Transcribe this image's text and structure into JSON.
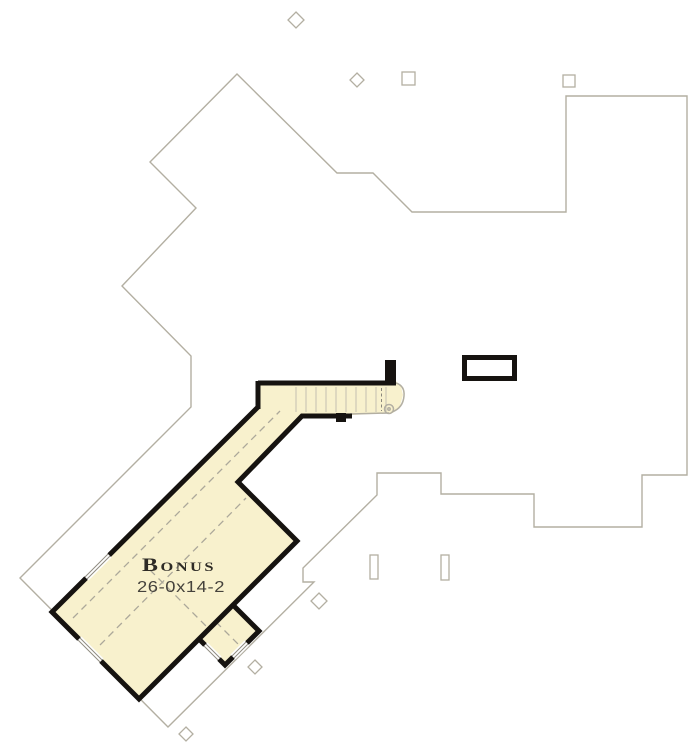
{
  "room": {
    "label": "Bonus",
    "dimensions": "26-0x14-2"
  },
  "colors": {
    "room_fill": "#F8F1CD",
    "wall": "#161310",
    "roofline": "#B3AFA2",
    "dash": "#ACA89A",
    "tread": "#C3BFB1",
    "window_line": "#8F8B80",
    "label": "#2E2B26",
    "dim_label": "#45423C"
  }
}
